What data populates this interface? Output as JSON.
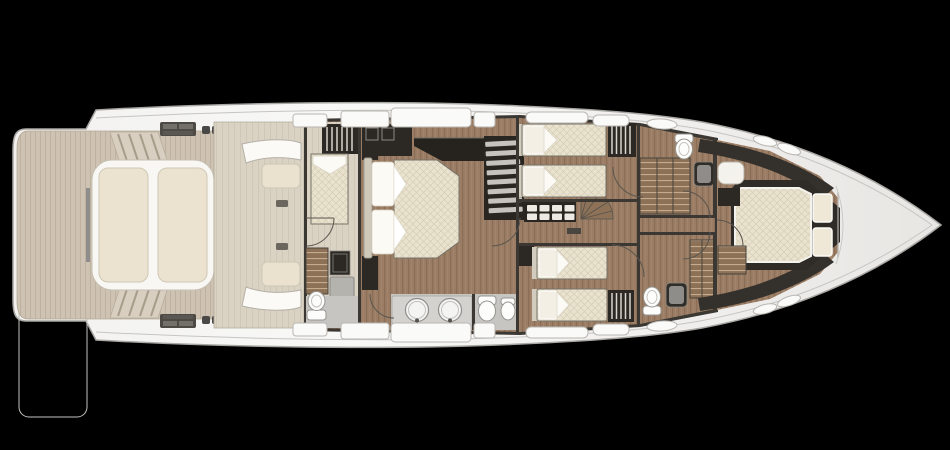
{
  "scene": {
    "kind": "yacht-lower-deck-floor-plan",
    "orientation": "bow-right",
    "background": "#000000"
  },
  "colors": {
    "bg": "#000000",
    "hullEdge": "#a9a7a3",
    "hullLine": "#c7c5c1",
    "teak": "#cec2b2",
    "teakLine": "#bfb19f",
    "slatDark": "#8e8d8b",
    "deck": "#dad3c4",
    "sunpadTrim": "#f8f7f3",
    "cushion": "#ebe3d0",
    "cushionEdge": "#cfc7b4",
    "stepFace": "#d8cfc0",
    "stepLine": "#a89c8a",
    "fitting": "#4d4a46",
    "wall": "#3b3733",
    "furnDark": "#2c2925",
    "wood": "#9a7d64",
    "woodLine": "#8a6e55",
    "woodLight": "#a98c72",
    "mattress": "#e9e2cf",
    "mattressLine": "#d7cdb4",
    "mattressEdge": "#77736a",
    "pillow": "#fbfaf5",
    "hanger": "#d8d5cf",
    "grayFloor": "#c6c5c2",
    "counter": "#d3d2cf",
    "fixture": "#fdfdfc",
    "fixtureEdge": "#96948f",
    "shower": "#8d7156",
    "showerLine": "#c4ab8d",
    "tread": "#c6c3be",
    "windowFill": "#fafaf8",
    "windowEdge": "#b9b6b1",
    "arc": "#5a554e"
  },
  "areas": [
    {
      "name": "swim-platform",
      "features": [
        "teak-decking",
        "deck-slats"
      ]
    },
    {
      "name": "aft-sunpad",
      "features": [
        "two-cushions",
        "side-steps",
        "deck-hardware"
      ]
    },
    {
      "name": "transom-garage",
      "features": [
        "curved-hatch-shells",
        "bench-seats"
      ]
    },
    {
      "name": "crew-cabin",
      "features": [
        "single-berth",
        "hanging-locker",
        "companionway-steps",
        "toilet",
        "hatch"
      ]
    },
    {
      "name": "master-cabin",
      "features": [
        "double-bed",
        "nightstands",
        "tv-console",
        "cabinets"
      ]
    },
    {
      "name": "master-bathroom",
      "features": [
        "twin-sinks",
        "toilet",
        "bidet",
        "vanity-counter"
      ]
    },
    {
      "name": "main-staircase",
      "features": [
        "straight-stairs",
        "curved-stairs",
        "shelf-unit"
      ]
    },
    {
      "name": "guest-cabin-port",
      "features": [
        "twin-beds",
        "wardrobe"
      ]
    },
    {
      "name": "guest-cabin-starboard",
      "features": [
        "twin-beds",
        "wardrobe",
        "tv-cabinet"
      ]
    },
    {
      "name": "guest-bathroom-port",
      "features": [
        "shower",
        "toilet",
        "sink"
      ]
    },
    {
      "name": "guest-bathroom-starboard",
      "features": [
        "shower",
        "toilet",
        "sink"
      ]
    },
    {
      "name": "vip-cabin",
      "features": [
        "island-double-bed",
        "pillows",
        "bench",
        "steps"
      ]
    },
    {
      "name": "bow",
      "features": [
        "hull-windows",
        "portlights"
      ]
    }
  ],
  "fixtures": {
    "beds": 7,
    "toilets": 4,
    "bidets": 1,
    "sinks": 4,
    "showers": 2,
    "staircases": 4,
    "door_arcs": 8,
    "hull_windows": 12,
    "portlights": 6
  }
}
